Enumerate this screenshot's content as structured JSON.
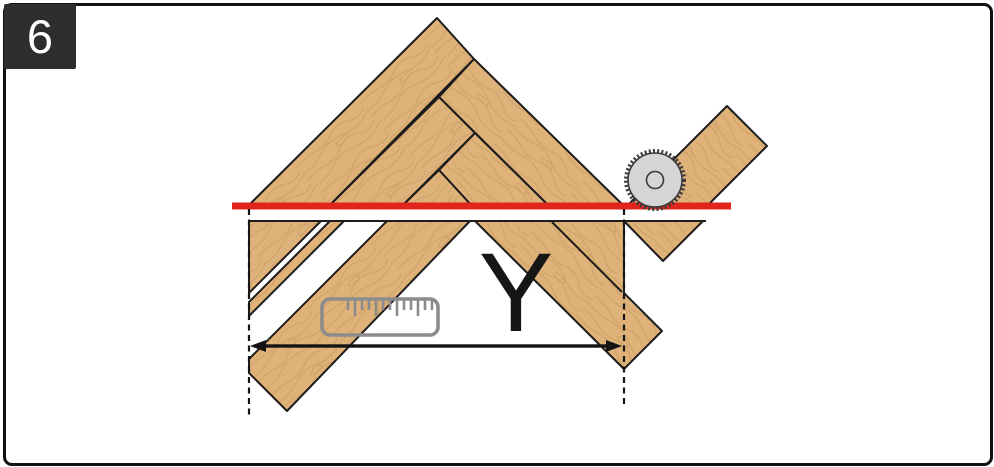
{
  "figure": {
    "step_number": "6",
    "measurement_label": "Y"
  },
  "colors": {
    "background": "#ffffff",
    "frame_border": "#111111",
    "badge_bg": "#2e2e2e",
    "badge_text": "#ffffff",
    "wood_base": "#dfb279",
    "wood_grain": "#bb8f56",
    "plank_outline": "#1c1c1c",
    "cut_line": "#e0261c",
    "dimension": "#141414",
    "dashed_line": "#141414",
    "ruler": "#8c8c8c",
    "saw_blade_fill": "#d5d5d5",
    "saw_blade_outline": "#3a3a3a",
    "label_text": "#161616"
  },
  "icons": {
    "saw_blade": "circular-saw-blade-icon",
    "ruler": "measuring-ruler-icon"
  }
}
